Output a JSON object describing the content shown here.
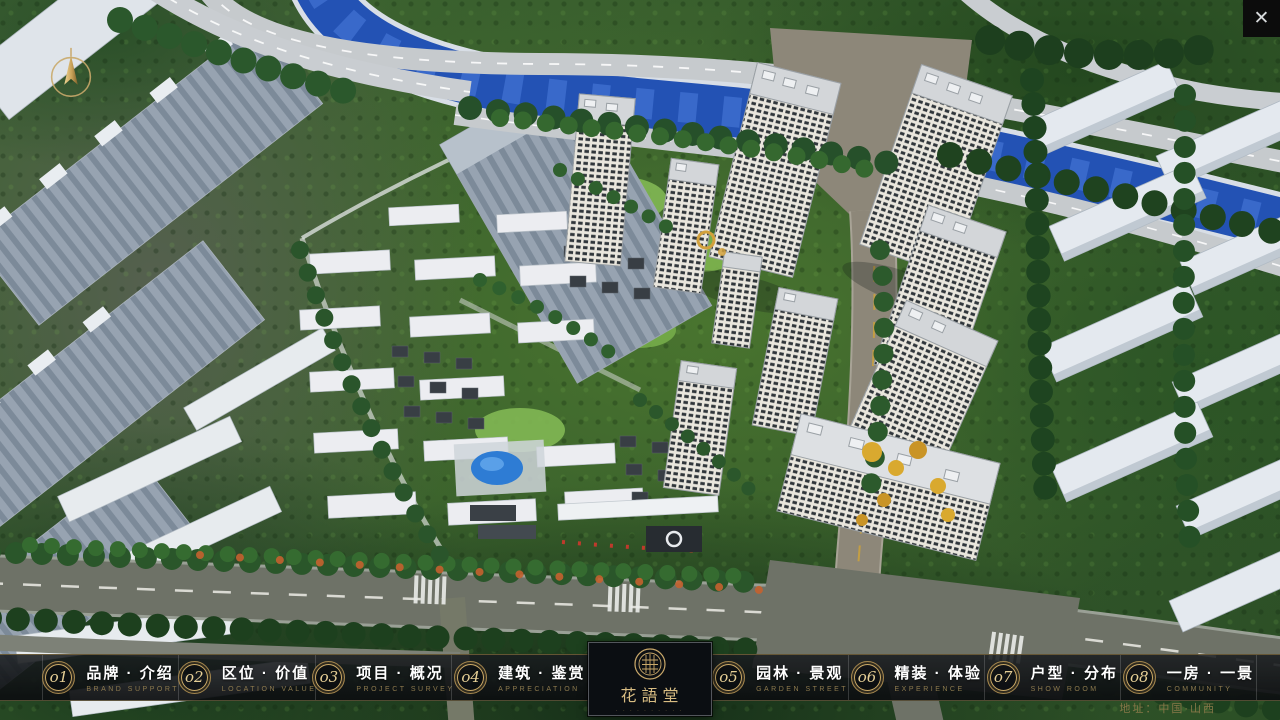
{
  "window": {
    "close_icon": "✕"
  },
  "icons": {
    "compass": "north-compass-arrow",
    "close": "close-x",
    "brand_seal": "hua-yu-tang-round-seal"
  },
  "menu": {
    "items": [
      {
        "num": "o1",
        "label": "品牌 · 介绍",
        "en": "BRAND SUPPORT"
      },
      {
        "num": "o2",
        "label": "区位 · 价值",
        "en": "LOCATION VALUE"
      },
      {
        "num": "o3",
        "label": "项目 · 概况",
        "en": "PROJECT SURVEY"
      },
      {
        "num": "o4",
        "label": "建筑 · 鉴赏",
        "en": "APPRECIATION"
      },
      {
        "num": "o5",
        "label": "园林 · 景观",
        "en": "GARDEN STREET"
      },
      {
        "num": "o6",
        "label": "精装 · 体验",
        "en": "EXPERIENCE"
      },
      {
        "num": "o7",
        "label": "户型 · 分布",
        "en": "SHOW ROOM"
      },
      {
        "num": "o8",
        "label": "一房 · 一景",
        "en": "COMMUNITY"
      }
    ]
  },
  "logo": {
    "title": "花語堂",
    "tagline": "· · · · · · · · · ·"
  },
  "footer": {
    "address": "地址：中国·山西"
  },
  "colors": {
    "accent_gold": "#c9a86a",
    "menu_text": "#ffffff",
    "menu_en_gold": "#8d7a4e",
    "river_blue": "#2352b4",
    "bar_bg": "#101316",
    "address_gold": "#877748"
  }
}
